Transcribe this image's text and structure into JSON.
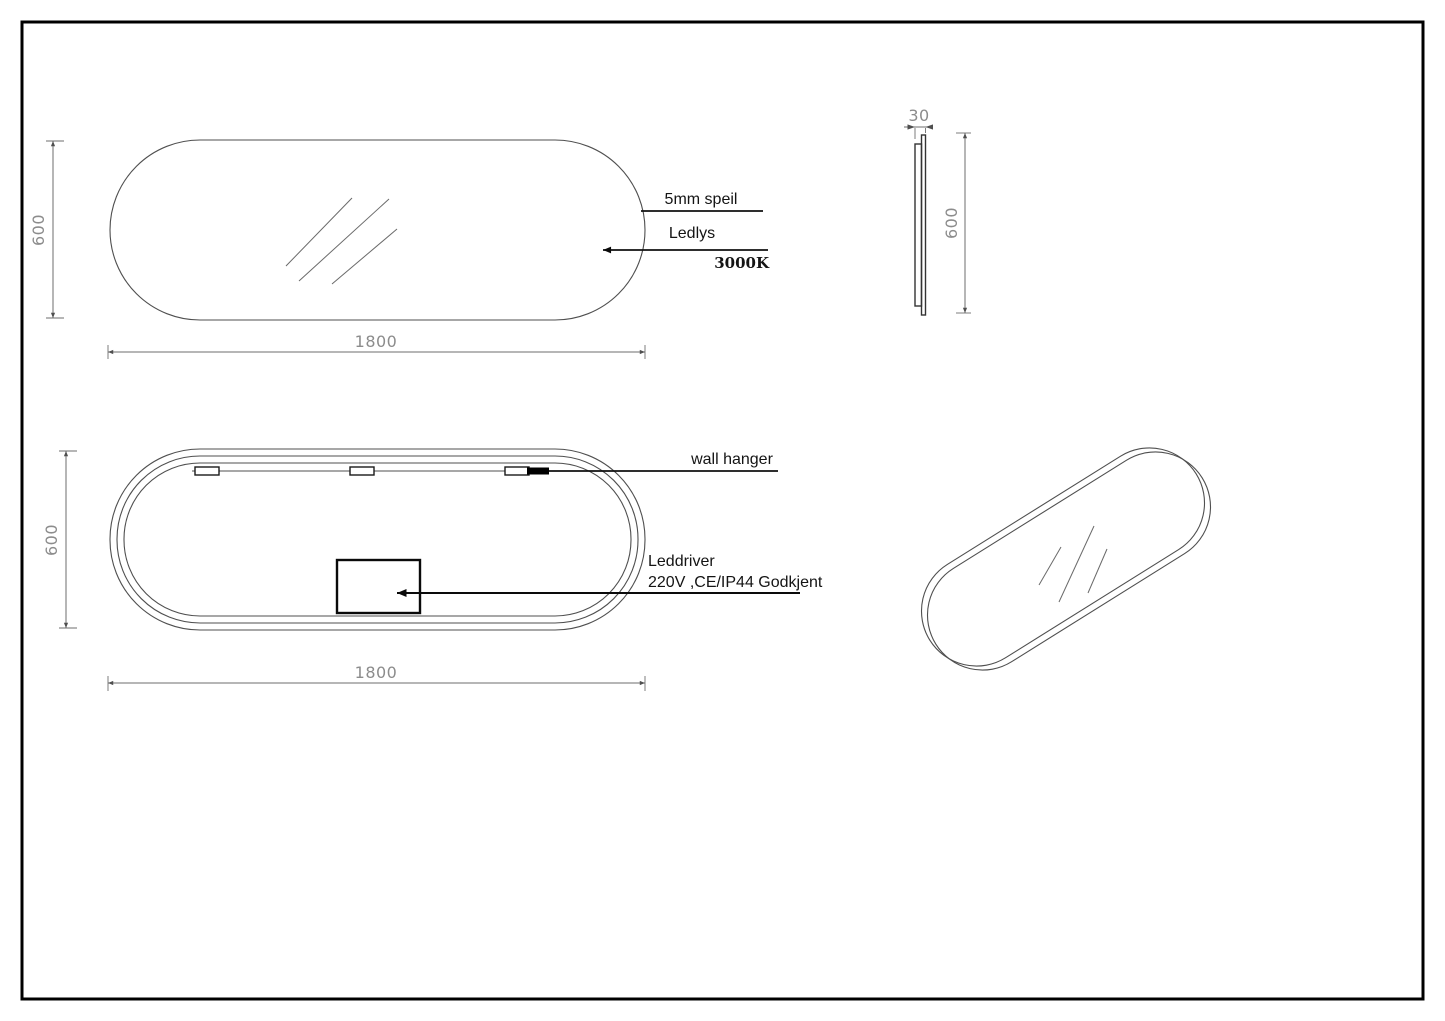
{
  "drawing": {
    "front_view": {
      "height_dim": "600",
      "width_dim": "1800",
      "callouts": {
        "glass": "5mm speil",
        "led": "Ledlys",
        "color_temperature": "3000K"
      }
    },
    "side_view": {
      "thickness_dim": "30",
      "height_dim": "600"
    },
    "back_view": {
      "height_dim": "600",
      "width_dim": "1800",
      "callouts": {
        "hanger": "wall hanger",
        "driver_line1": "Leddriver",
        "driver_line2": "220V ,CE/IP44 Godkjent"
      }
    },
    "colors": {
      "outline": "#4f4f4f",
      "leader": "#111111",
      "dim_text": "#8c8c8c",
      "label_text": "#141414",
      "frame": "#000000",
      "background": "#ffffff"
    }
  }
}
